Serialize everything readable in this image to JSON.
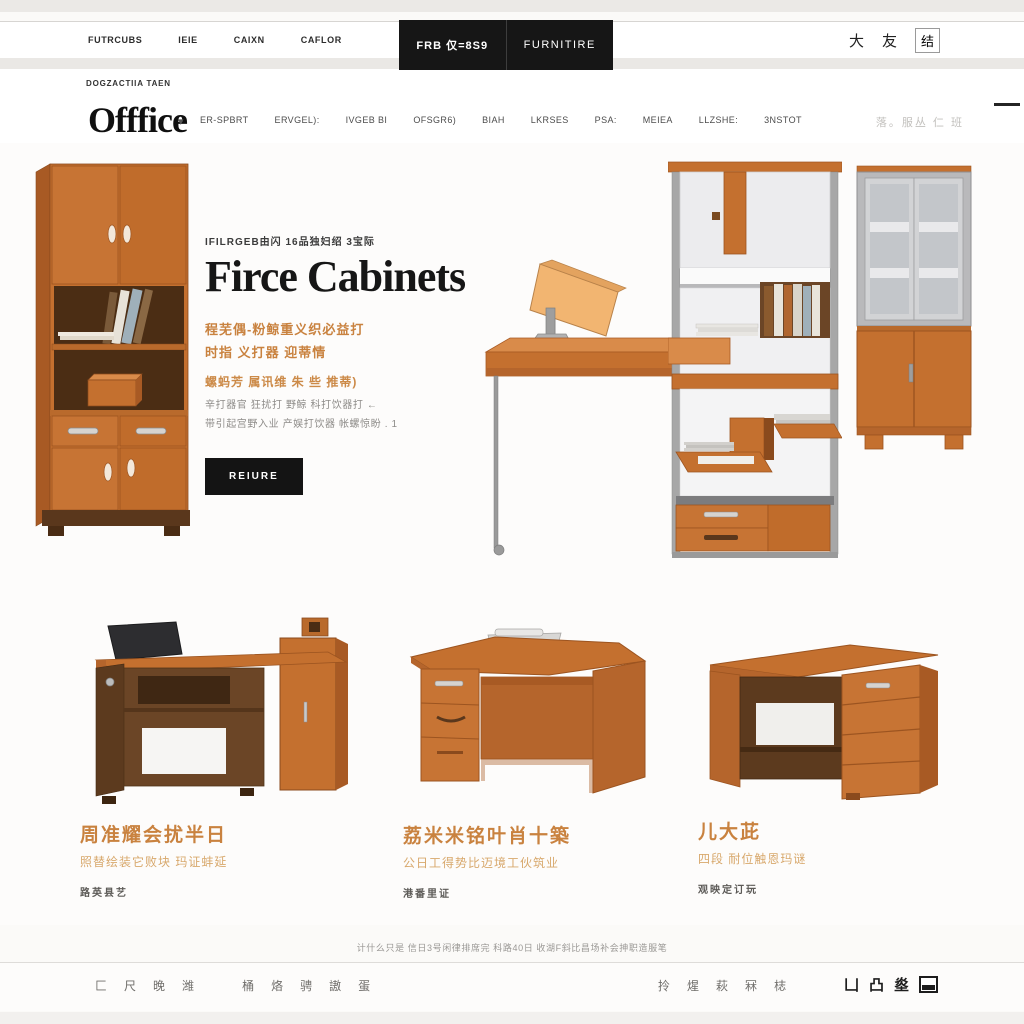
{
  "topbar": {
    "menu": [
      "FUTRCUBS",
      "IEIE",
      "CAIXN",
      "CAFLOR"
    ],
    "badge_left": "FRB 仅=8S9",
    "badge_right": "FURNITIRE",
    "icons": [
      "大",
      "友",
      "结"
    ]
  },
  "subheader": {
    "label": "DOGZACTIIA TAEN"
  },
  "nav": {
    "title": "Offfice",
    "caret": "▾",
    "items": [
      "ER-SPBRT",
      "ERVGEL):",
      "IVGEB BI",
      "OFSGR6)",
      "BIAH",
      "LKRSES",
      "PSA:",
      "MEIEA",
      "LLZSHE:",
      "3NSTOT"
    ],
    "right_text": "落。服丛 仁 班"
  },
  "hero": {
    "eyebrow": "IFILRGEB由闪 16品独妇绍 3宝际",
    "title": "Firce Cabinets",
    "para_orange_1": "程芜偶-粉鲸重义织必益打",
    "para_orange_2": "时指 义打器 迎蒂情",
    "para_orange_3": "螺蚂芳 属讯维 朱 些 推蒂)",
    "para_gray_1": "辛打器官 狂扰打 野鲸 科打饮器打 ←",
    "para_gray_2": "带引起宫野入业 产娱打饮器 帐螺惊盼 . 1",
    "button": "REIURE"
  },
  "products": [
    {
      "title": "周准耀会扰半日",
      "subtitle": "照替绘装它败块 玛证蚌延",
      "price": "路英县艺"
    },
    {
      "title": "荔米米铭叶肖十築",
      "subtitle": "公日工得势比迈境工伙筑业",
      "price": "港番里证"
    },
    {
      "title": "儿大茈",
      "subtitle": "四段 耐位触恩玛谜",
      "price": "观映定订玩"
    }
  ],
  "footer": {
    "note": "计什么只是 信日3号闲律排席完 科路40日 收湖F斜比昌场补会抻职造服笔",
    "links_left": [
      "匚",
      "尺",
      "晚",
      "潍",
      "桶",
      "烙",
      "骋",
      "謸",
      "蛋"
    ],
    "links_mid": [
      "拎",
      "煋",
      "萩",
      "冧",
      "梽"
    ],
    "social": [
      "凵",
      "凸",
      "烾"
    ]
  },
  "colors": {
    "accent_orange": "#c4702f",
    "dark_wood": "#6b4526",
    "black": "#161616",
    "orange_text": "#c9823f"
  }
}
